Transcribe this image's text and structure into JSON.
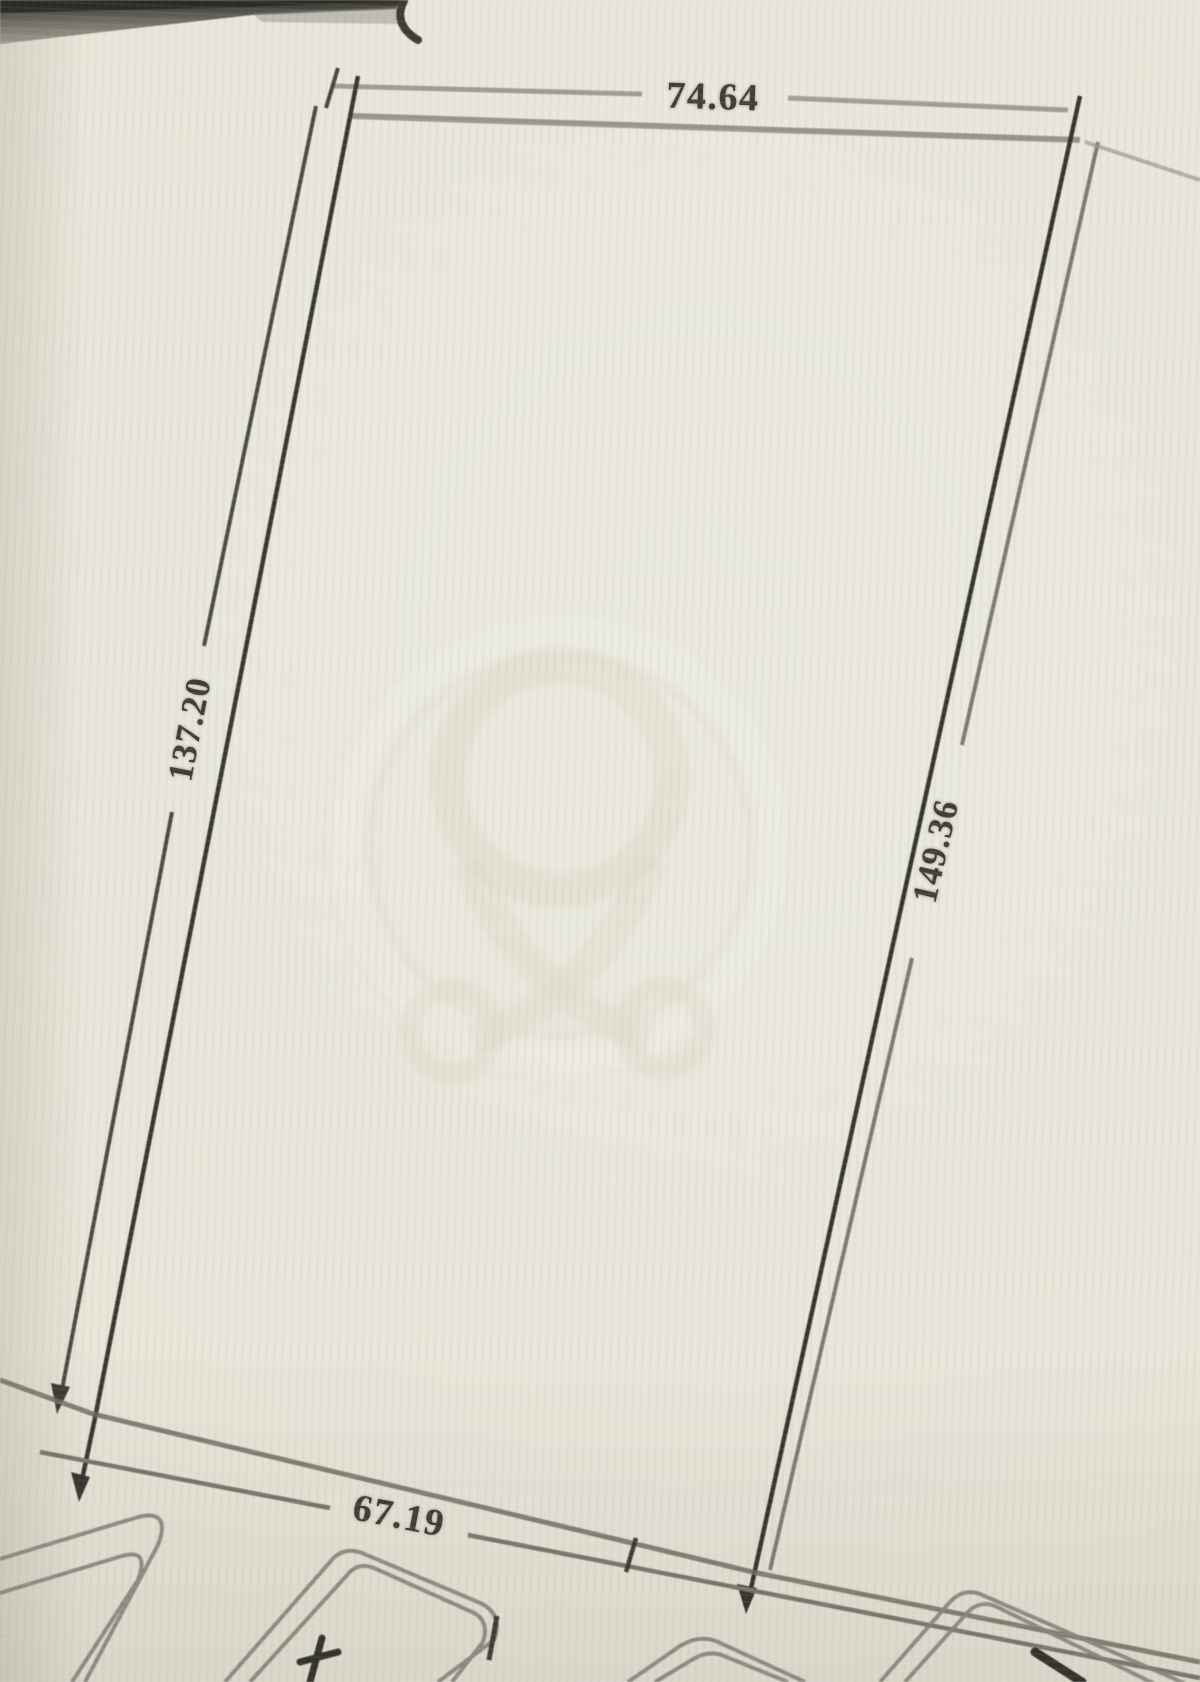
{
  "drawing": {
    "description": "photographed cadastral survey sketch of a four-sided land parcel with boundary dimension lines and neighboring parcel outlines"
  },
  "parcel": {
    "side_labels": {
      "top": "74.64",
      "left": "137.20",
      "right": "149.36",
      "bottom": "67.19"
    }
  },
  "watermark": {
    "icon": "map-pin-loop-logo-watermark"
  },
  "colors": {
    "paper": "#e7e5d8",
    "ink_dark": "#34332d",
    "ink_gray": "#8d8b80",
    "label_text": "#3e3c35"
  }
}
